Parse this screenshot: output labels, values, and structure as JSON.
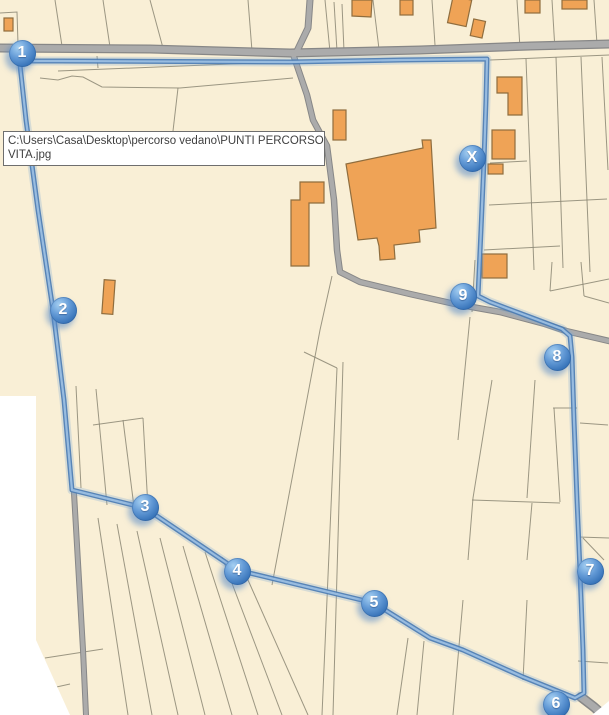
{
  "tooltip": {
    "line1": "C:\\Users\\Casa\\Desktop\\percorso vedano\\PUNTI PERCORSO",
    "line2": "VITA.jpg"
  },
  "markers": [
    {
      "label": "1",
      "x": 22,
      "y": 53
    },
    {
      "label": "2",
      "x": 63,
      "y": 310
    },
    {
      "label": "3",
      "x": 145,
      "y": 507
    },
    {
      "label": "4",
      "x": 237,
      "y": 571
    },
    {
      "label": "5",
      "x": 374,
      "y": 603
    },
    {
      "label": "6",
      "x": 556,
      "y": 704
    },
    {
      "label": "7",
      "x": 590,
      "y": 571
    },
    {
      "label": "8",
      "x": 557,
      "y": 357
    },
    {
      "label": "9",
      "x": 463,
      "y": 296
    },
    {
      "label": "X",
      "x": 472,
      "y": 158
    }
  ],
  "colors": {
    "background": "#f9efd6",
    "parcel": "#8b8673",
    "road_fill": "#ababab",
    "road_casing": "#878787",
    "building_fill": "#efa356",
    "building_stroke": "#8f6d3e",
    "route_dark": "#4c7db4",
    "route_light": "#9cbfe2",
    "marker_blue": "#3a76bb",
    "nodata": "#ffffff"
  }
}
